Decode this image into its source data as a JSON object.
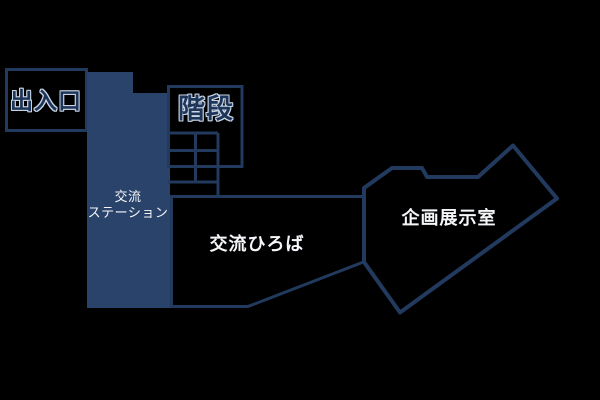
{
  "map_title": "facility-floor-map",
  "colors": {
    "background": "#000000",
    "wall": "#223a5e",
    "station_fill": "#2a436a",
    "label_light": "#f4f6f9",
    "label_dark": "#1d3558",
    "label_outline": "#c9d4e4"
  },
  "rooms": {
    "entrance": {
      "label": "出入口"
    },
    "station": {
      "label_line1": "交流",
      "label_line2": "ステーション"
    },
    "stairs": {
      "label": "階段"
    },
    "plaza": {
      "label": "交流ひろば"
    },
    "exhibition": {
      "label": "企画展示室"
    }
  }
}
